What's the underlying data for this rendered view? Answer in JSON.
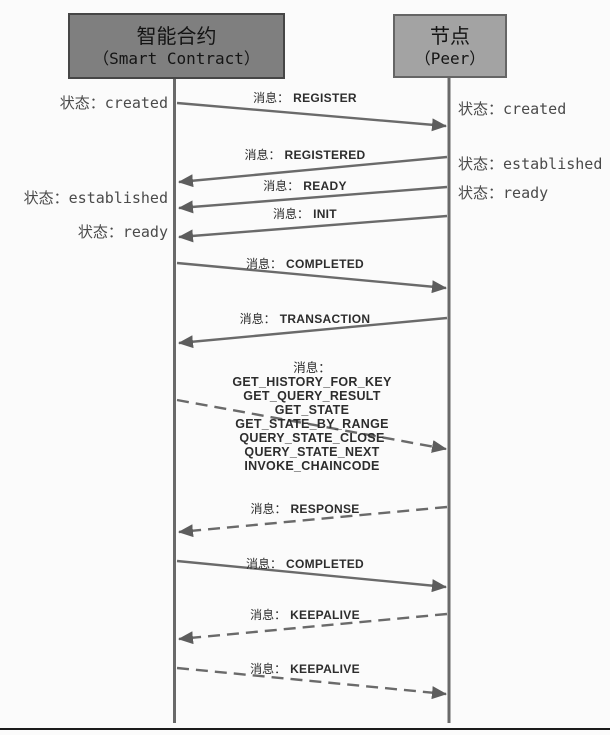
{
  "actors": {
    "left": {
      "title": "智能合约",
      "subtitle": "（Smart Contract）"
    },
    "right": {
      "title": "节点",
      "subtitle": "（Peer）"
    }
  },
  "states": {
    "left": [
      {
        "prefix": "状态：",
        "value": "created"
      },
      {
        "prefix": "状态：",
        "value": "established"
      },
      {
        "prefix": "状态：",
        "value": "ready"
      }
    ],
    "right": [
      {
        "prefix": "状态：",
        "value": "created"
      },
      {
        "prefix": "状态：",
        "value": "established"
      },
      {
        "prefix": "状态：",
        "value": "ready"
      }
    ]
  },
  "messages": [
    {
      "prefix": "消息：",
      "value": "REGISTER",
      "style": "solid",
      "direction": "to-peer"
    },
    {
      "prefix": "消息：",
      "value": "REGISTERED",
      "style": "solid",
      "direction": "to-contract"
    },
    {
      "prefix": "消息：",
      "value": "READY",
      "style": "solid",
      "direction": "to-contract"
    },
    {
      "prefix": "消息：",
      "value": "INIT",
      "style": "solid",
      "direction": "to-contract"
    },
    {
      "prefix": "消息：",
      "value": "COMPLETED",
      "style": "solid",
      "direction": "to-peer"
    },
    {
      "prefix": "消息：",
      "value": "TRANSACTION",
      "style": "solid",
      "direction": "to-contract"
    },
    {
      "prefix": "消息：",
      "values": [
        "GET_HISTORY_FOR_KEY",
        "GET_QUERY_RESULT",
        "GET_STATE",
        "GET_STATE_BY_RANGE",
        "QUERY_STATE_CLOSE",
        "QUERY_STATE_NEXT",
        "INVOKE_CHAINCODE"
      ],
      "style": "dashed",
      "direction": "to-peer"
    },
    {
      "prefix": "消息：",
      "value": "RESPONSE",
      "style": "dashed",
      "direction": "to-contract"
    },
    {
      "prefix": "消息：",
      "value": "COMPLETED",
      "style": "solid",
      "direction": "to-peer"
    },
    {
      "prefix": "消息：",
      "value": "KEEPALIVE",
      "style": "dashed",
      "direction": "to-contract"
    },
    {
      "prefix": "消息：",
      "value": "KEEPALIVE",
      "style": "dashed",
      "direction": "to-peer"
    }
  ],
  "colors": {
    "line": "#6a6a6a",
    "arrowhead": "#5d5d5d",
    "box_left_fill": "#7f7f7f",
    "box_right_fill": "#a3a3a3",
    "state_text": "#4a4a4a",
    "message_text": "#2d2d2d",
    "bottom_rule": "#1b1b1b"
  }
}
